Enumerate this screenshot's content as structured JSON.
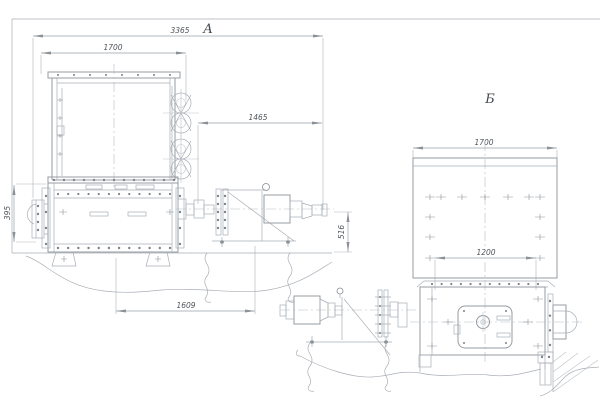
{
  "drawing": {
    "views": {
      "a": {
        "label": "А",
        "dims": {
          "overall": "3365",
          "hopper": "1700",
          "upper": "1465",
          "left_height": "395",
          "right_height": "516",
          "base": "1609"
        }
      },
      "b": {
        "label": "Б",
        "dims": {
          "hopper": "1700",
          "opening": "1200"
        }
      }
    },
    "colors": {
      "line": "#9aa1a8",
      "text": "#4f555b",
      "background": "#ffffff"
    }
  }
}
